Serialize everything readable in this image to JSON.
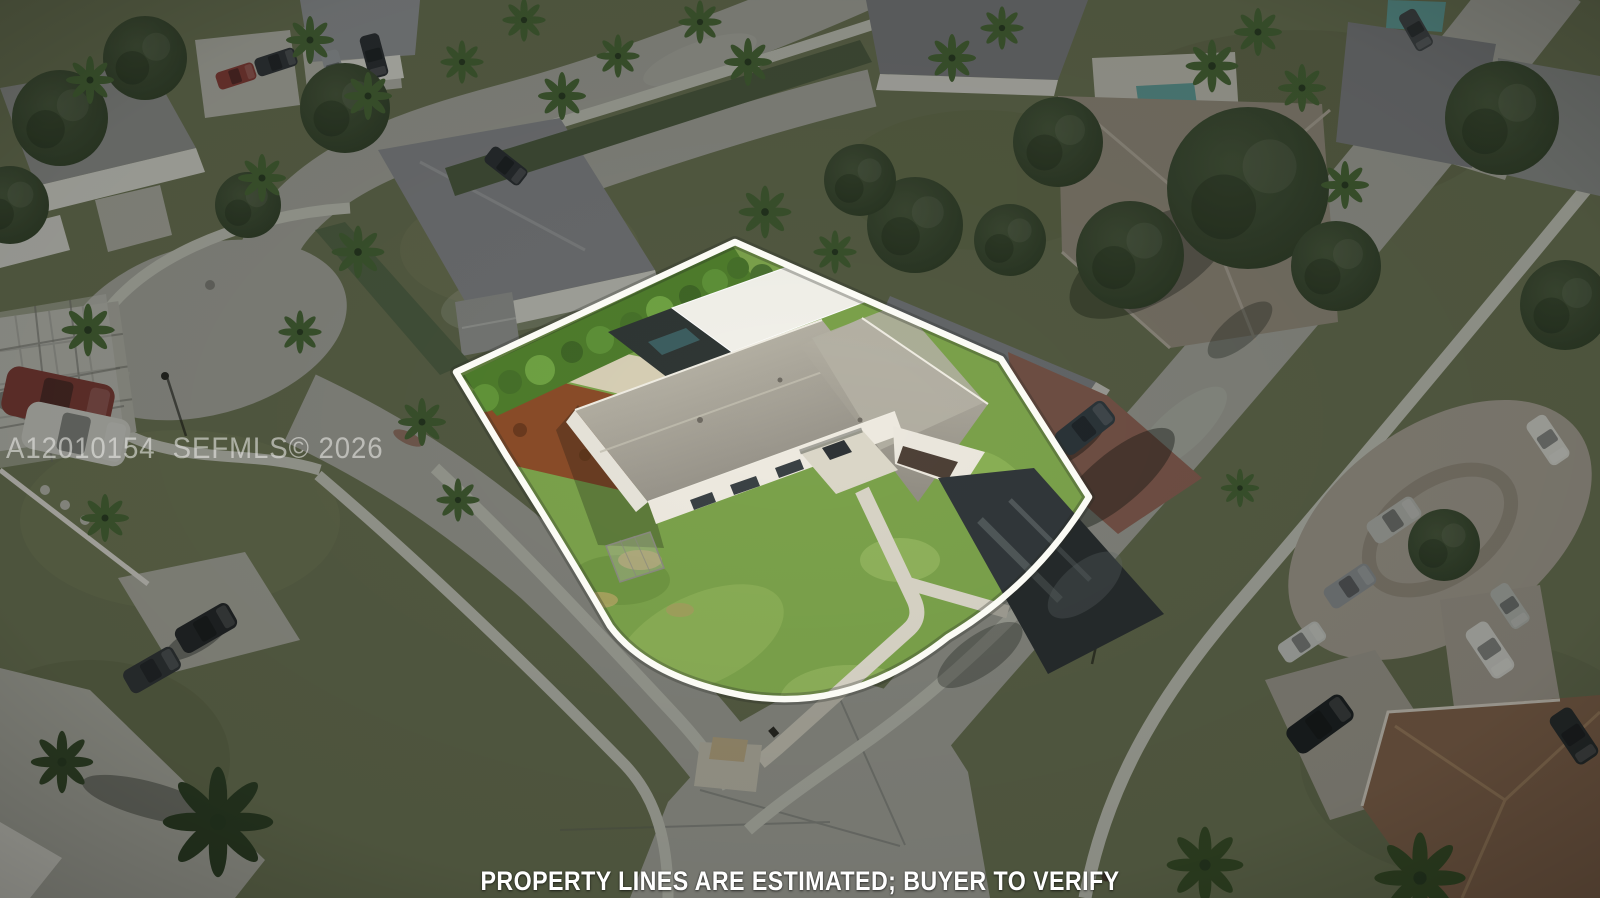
{
  "page": {
    "type": "real-estate-aerial-photo",
    "width": 1600,
    "height": 898
  },
  "overlays": {
    "watermark_text": "A12010154  SEFMLS© 2026",
    "disclaimer_text": "PROPERTY LINES ARE ESTIMATED; BUYER TO VERIFY"
  },
  "colors": {
    "outline": "#fbfbf5",
    "shade": "rgba(8,10,8,0.28)",
    "lawn": "#7ba24b",
    "road": "#a9aaa1",
    "sidewalk": "#c7c8bd",
    "ground": "#6e7656",
    "roof": "#a8a49a",
    "asphalt": "#31373a",
    "mulch": "#8a4c29",
    "sand": "#d7cfb5",
    "hedge": "#4e7c2c",
    "pool": "#63a09c",
    "brick": "#96685a",
    "wall": "#eeeae0",
    "concrete": "#d8d4c6"
  },
  "scene": {
    "description": "Aerial drone view of a suburban corner lot outlined in white; surrounding neighborhood darkened for emphasis",
    "featured_property": {
      "outline_color": "#ffffff",
      "house": "L-shaped single-story house with gray shingle roof, white walls and double garage",
      "yard": "large green corner lawn, rear hedge, mulch beds, sand path, dark asphalt driveway, white pool-enclosure roof"
    },
    "surroundings": [
      "curving residential streets with sidewalks",
      "cul-de-sac",
      "neighboring single-family homes",
      "palm trees and shade trees",
      "parked cars and pickup trucks",
      "backyard swimming pools"
    ]
  }
}
